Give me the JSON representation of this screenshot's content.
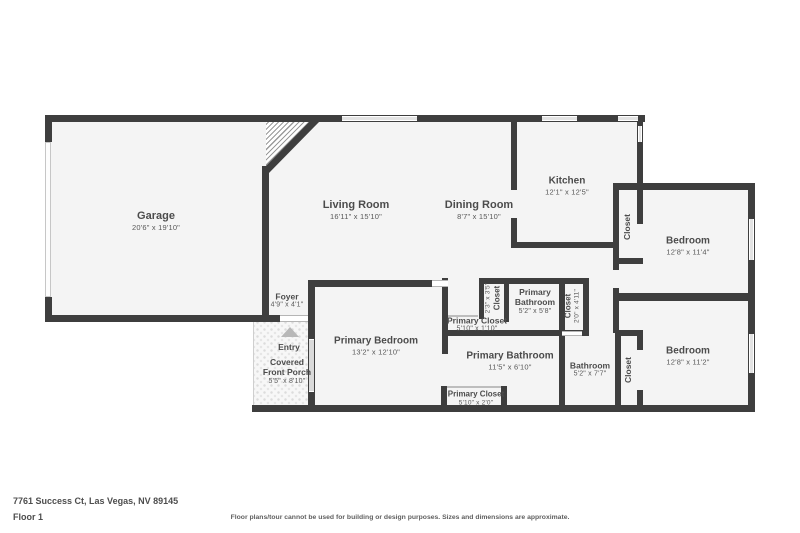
{
  "colors": {
    "wall": "#3e3e3e",
    "floor": "#f4f4f4",
    "window": "#e3e3e3",
    "room_name_text": "#4c4c4c",
    "room_dims_text": "#585858",
    "entry_arrow": "#b8b8b8"
  },
  "rooms": [
    {
      "id": "garage",
      "name": "Garage",
      "dims": "20'6\" x 19'10\""
    },
    {
      "id": "living-room",
      "name": "Living Room",
      "dims": "16'11\" x 15'10\""
    },
    {
      "id": "dining-room",
      "name": "Dining Room",
      "dims": "8'7\" x 15'10\""
    },
    {
      "id": "kitchen",
      "name": "Kitchen",
      "dims": "12'1\" x 12'5\""
    },
    {
      "id": "closet-kitchen",
      "name": "Closet",
      "dims": ""
    },
    {
      "id": "bedroom-1",
      "name": "Bedroom",
      "dims": "12'8\" x 11'4\""
    },
    {
      "id": "foyer",
      "name": "Foyer",
      "dims": "4'9\" x 4'1\""
    },
    {
      "id": "entry",
      "name": "Entry",
      "dims": ""
    },
    {
      "id": "covered-front-porch",
      "name": "Covered Front Porch",
      "dims": "5'5\" x 8'10\""
    },
    {
      "id": "primary-bedroom",
      "name": "Primary Bedroom",
      "dims": "13'2\" x 12'10\""
    },
    {
      "id": "primary-closet-upper",
      "name": "Primary Closet",
      "dims": "5'10\" x 1'10\""
    },
    {
      "id": "closet-small",
      "name": "Closet",
      "dims": "2'3\" x 3'5\""
    },
    {
      "id": "primary-bathroom-small",
      "name": "Primary Bathroom",
      "dims": "5'2\" x 5'8\""
    },
    {
      "id": "closet-hall",
      "name": "Closet",
      "dims": "2'0\" x 4'11\""
    },
    {
      "id": "primary-bathroom",
      "name": "Primary Bathroom",
      "dims": "11'5\" x 6'10\""
    },
    {
      "id": "bathroom",
      "name": "Bathroom",
      "dims": "5'2\" x 7'7\""
    },
    {
      "id": "closet-bedroom-2",
      "name": "Closet",
      "dims": ""
    },
    {
      "id": "bedroom-2",
      "name": "Bedroom",
      "dims": "12'8\" x 11'2\""
    },
    {
      "id": "primary-closet-lower",
      "name": "Primary Closet",
      "dims": "5'10\" x 2'0\""
    }
  ],
  "footer": {
    "address": "7761 Success Ct, Las Vegas, NV 89145",
    "floor_label": "Floor 1",
    "disclaimer": "Floor plans/tour cannot be used for building or design purposes. Sizes and dimensions are approximate."
  }
}
